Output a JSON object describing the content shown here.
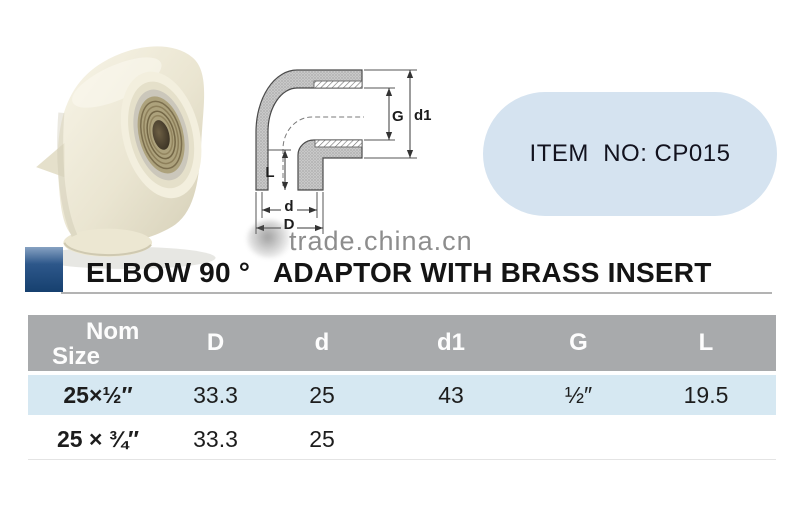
{
  "title": {
    "text": "ELBOW 90 °   ADAPTOR WITH BRASS INSERT"
  },
  "badge": {
    "text": "ITEM  NO: CP015",
    "bg_color": "#d5e3f0"
  },
  "watermark": {
    "text": "trade.china.cn",
    "color": "#8d8d8d"
  },
  "colors": {
    "accent_navy": "#16406f",
    "table_header_bg": "#a8aaac",
    "table_row_highlight_bg": "#d6e8f2",
    "product_body": "#eae5d1",
    "brass_insert": "#ada27c"
  },
  "diagram": {
    "dim_g": "G",
    "dim_d1": "d1",
    "dim_l": "L",
    "dim_d": "d",
    "dim_big_d": "D"
  },
  "table": {
    "header": {
      "nom_line1": "Nom",
      "nom_line2": "Size",
      "col_D": "D",
      "col_d": "d",
      "col_d1": "d1",
      "col_G": "G",
      "col_L": "L"
    },
    "rows": [
      {
        "nom": "25×½″",
        "D": "33.3",
        "d": "25",
        "d1": "43",
        "G": "½″",
        "L": "19.5"
      },
      {
        "nom": "25 × ¾″",
        "D": "33.3",
        "d": "25",
        "d1": "",
        "G": "",
        "L": ""
      }
    ]
  }
}
